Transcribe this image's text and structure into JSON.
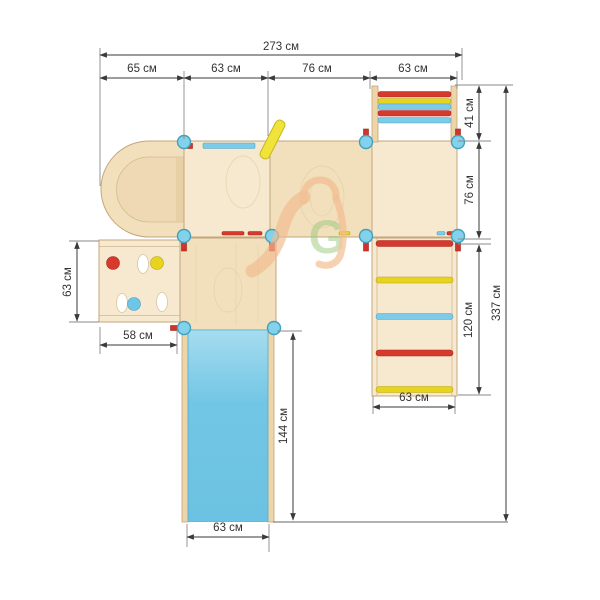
{
  "page": {
    "background": "#ffffff",
    "description": "Plan-view technical drawing of a children's play structure (tunnel arch, panels, slide, ladders, climbing wall) with dimension annotations"
  },
  "dims": {
    "total_width": "273 см",
    "top": [
      "65 см",
      "63 см",
      "76 см",
      "63 см"
    ],
    "right_ladder_depth": "41 см",
    "right_panel_depth": "76 см",
    "wall_ladder_length": "120 см",
    "total_height": "337 см",
    "wall_ladder_width": "63 см",
    "climb_wall_height": "63 см",
    "climb_wall_width": "58 см",
    "slide_length": "144 см",
    "slide_width": "63 см"
  },
  "watermark": {
    "letter": "G"
  },
  "colors": {
    "dim_line": "#3a3a3a",
    "ext_line": "#8a8a8a",
    "wood_panel": "#f6e9cf",
    "wood_panel_alt": "#f2e0bd",
    "wood_inner": "#eed9b4",
    "wood_edge": "#c7a57a",
    "wood_rail": "#ebd5a9",
    "slide_blue": "#72c6e5",
    "slide_blue_light": "#a6dcef",
    "rung_red": "#d63a2c",
    "rung_yellow": "#e8d41f",
    "rung_blue": "#7ccbe9",
    "connector_blue": "#82d2ec",
    "connector_edge": "#43a0bd",
    "peg_red": "#d0342a",
    "pole_yellow": "#f0e339",
    "logo_orange": "#f2bb8e",
    "logo_green": "#9cc97c"
  }
}
